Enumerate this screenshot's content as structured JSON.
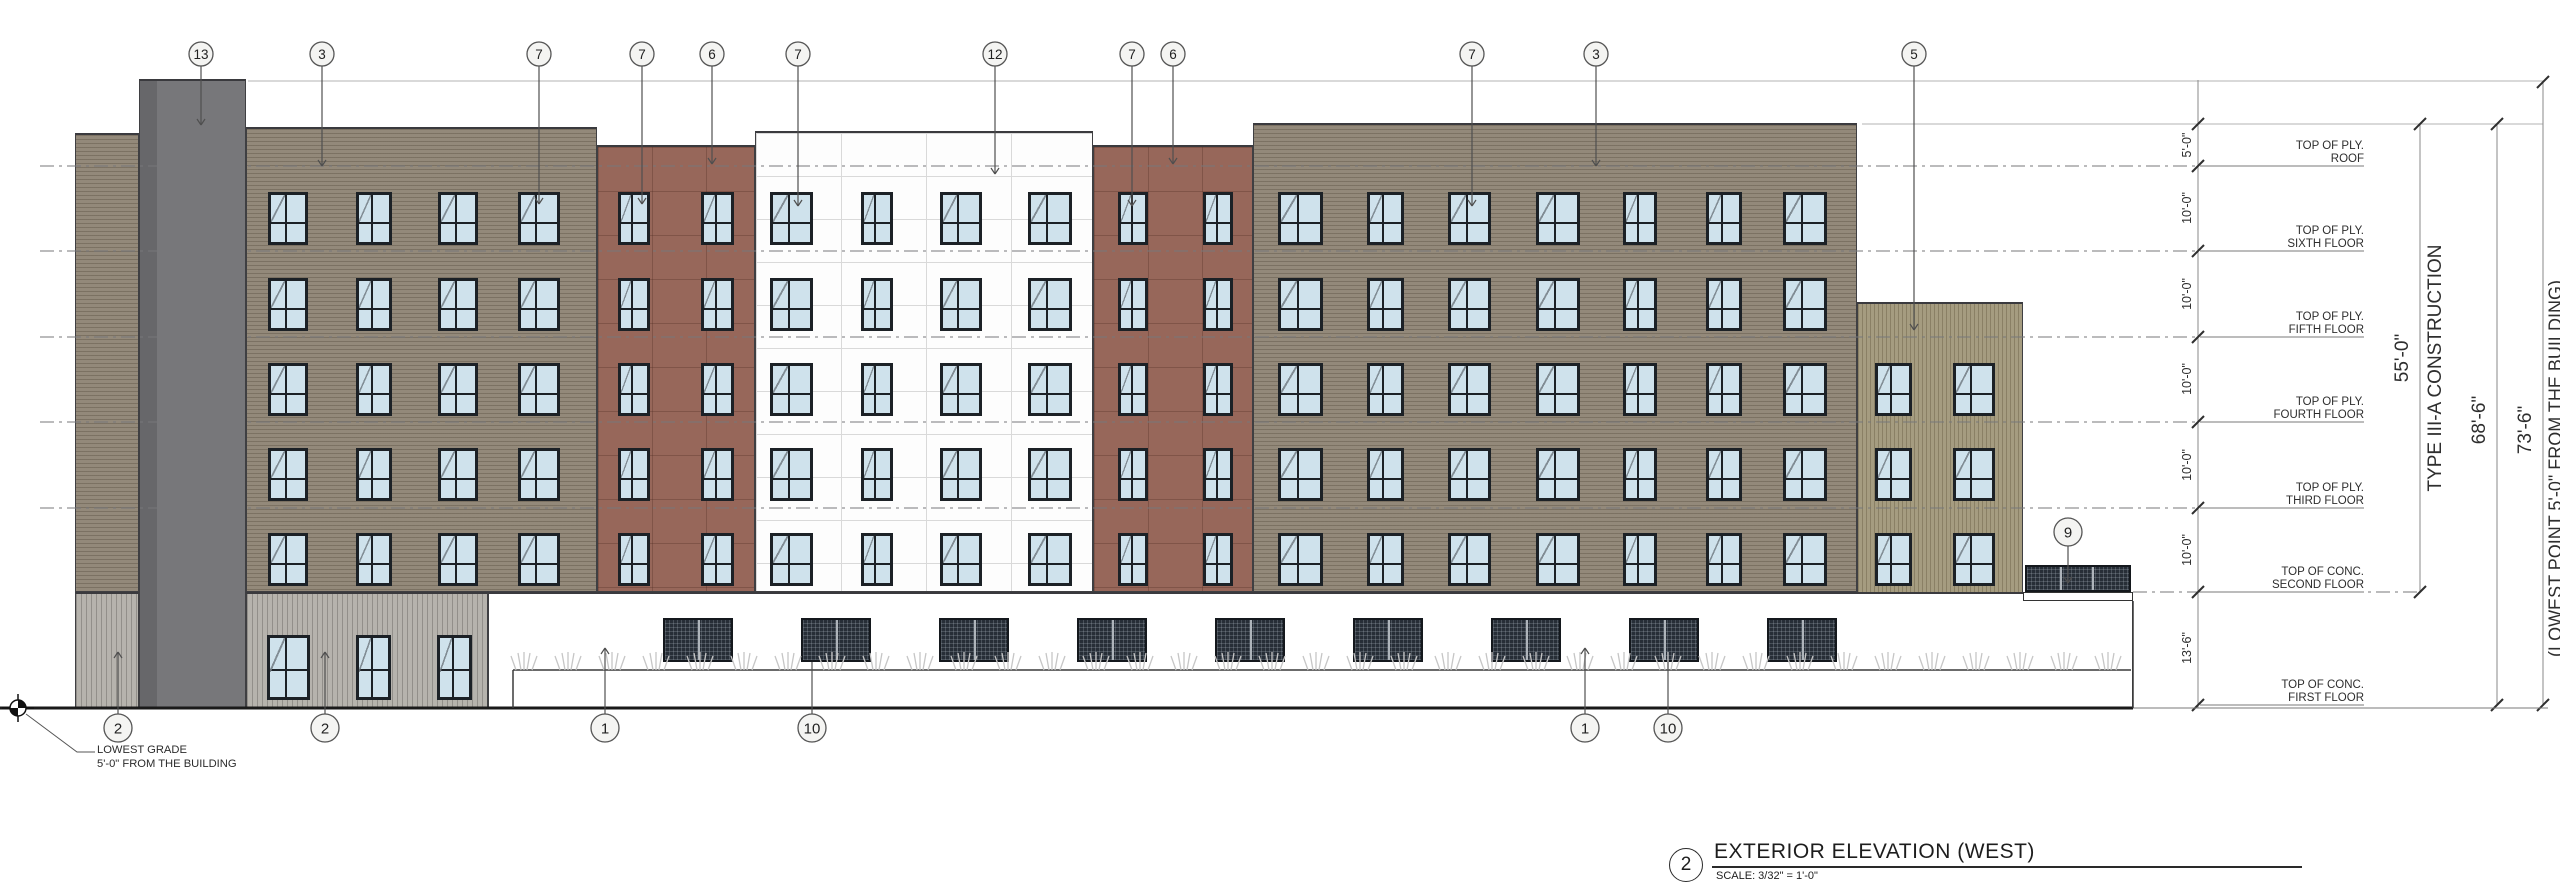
{
  "title_block": {
    "number": "2",
    "title": "EXTERIOR ELEVATION (WEST)",
    "scale": "SCALE:   3/32\" = 1'-0\""
  },
  "notes": {
    "grade_line1": "LOWEST GRADE",
    "grade_line2": "5'-0\" FROM THE BUILDING",
    "construction_type": "TYPE III-A CONSTRUCTION",
    "lowest_point": "(LOWEST POINT 5'-0\" FROM THE BUILDING)"
  },
  "floor_labels": [
    {
      "y": 166,
      "line1": "TOP OF PLY.",
      "line2": "ROOF"
    },
    {
      "y": 251,
      "line1": "TOP OF PLY.",
      "line2": "SIXTH FLOOR"
    },
    {
      "y": 337,
      "line1": "TOP OF PLY.",
      "line2": "FIFTH FLOOR"
    },
    {
      "y": 422,
      "line1": "TOP OF PLY.",
      "line2": "FOURTH FLOOR"
    },
    {
      "y": 508,
      "line1": "TOP OF PLY.",
      "line2": "THIRD FLOOR"
    },
    {
      "y": 592,
      "line1": "TOP OF CONC.",
      "line2": "SECOND FLOOR"
    },
    {
      "y": 705,
      "line1": "TOP OF CONC.",
      "line2": "FIRST FLOOR"
    }
  ],
  "dims": {
    "story": [
      {
        "label": "5'-0\"",
        "y": 145
      },
      {
        "label": "10'-0\"",
        "y": 208
      },
      {
        "label": "10'-0\"",
        "y": 294
      },
      {
        "label": "10'-0\"",
        "y": 379
      },
      {
        "label": "10'-0\"",
        "y": 465
      },
      {
        "label": "10'-0\"",
        "y": 550
      },
      {
        "label": "13'-6\"",
        "y": 648
      }
    ],
    "overall": [
      {
        "label": "55'-0\"",
        "x": 2420,
        "y1": 124,
        "y2": 592,
        "tx": 2403,
        "ty": 358
      },
      {
        "label": "68'-6\"",
        "x": 2497,
        "y1": 124,
        "y2": 705,
        "tx": 2480,
        "ty": 420
      },
      {
        "label": "73'-6\"",
        "x": 2543,
        "y1": 82,
        "y2": 705,
        "tx": 2526,
        "ty": 430
      }
    ],
    "construction_tx": 2436,
    "construction_ty": 368,
    "lowest_tx": 2556,
    "lowest_ty": 468,
    "tick_line_x": 2198,
    "tick_levels": [
      124,
      166,
      251,
      337,
      422,
      508,
      592,
      705
    ]
  },
  "keynotes_top": [
    {
      "label": "13",
      "x": 201,
      "tip": 125
    },
    {
      "label": "3",
      "x": 322,
      "tip": 166
    },
    {
      "label": "7",
      "x": 539,
      "tip": 204
    },
    {
      "label": "7",
      "x": 642,
      "tip": 204
    },
    {
      "label": "6",
      "x": 712,
      "tip": 164
    },
    {
      "label": "7",
      "x": 798,
      "tip": 206
    },
    {
      "label": "12",
      "x": 995,
      "tip": 174
    },
    {
      "label": "7",
      "x": 1132,
      "tip": 206
    },
    {
      "label": "6",
      "x": 1173,
      "tip": 164
    },
    {
      "label": "7",
      "x": 1472,
      "tip": 206
    },
    {
      "label": "3",
      "x": 1596,
      "tip": 166
    },
    {
      "label": "5",
      "x": 1914,
      "tip": 330
    }
  ],
  "keynotes_bottom": [
    {
      "label": "2",
      "x": 118,
      "tip": 652,
      "arrow": true
    },
    {
      "label": "2",
      "x": 325,
      "tip": 652,
      "arrow": true
    },
    {
      "label": "1",
      "x": 605,
      "tip": 648,
      "arrow": true
    },
    {
      "label": "10",
      "x": 812,
      "tip": 662,
      "arrow": false
    },
    {
      "label": "1",
      "x": 1585,
      "tip": 648,
      "arrow": true
    },
    {
      "label": "10",
      "x": 1668,
      "tip": 662,
      "arrow": false
    }
  ],
  "keynote_9": {
    "label": "9",
    "x": 2068,
    "y": 532,
    "tip": 583
  },
  "building": {
    "sections": [
      {
        "name": "left-wing",
        "x": 75,
        "y": 133,
        "w": 64,
        "h": 459,
        "tex": "taupe"
      },
      {
        "name": "left-wing-base",
        "x": 75,
        "y": 592,
        "w": 64,
        "h": 116,
        "tex": "vgray"
      },
      {
        "name": "elevator-band",
        "x": 139,
        "y": 79,
        "w": 107,
        "h": 629,
        "tex": "dark"
      },
      {
        "name": "facade-taupe-left",
        "x": 246,
        "y": 127,
        "w": 351,
        "h": 465,
        "tex": "taupe"
      },
      {
        "name": "facade-brick-left",
        "x": 597,
        "y": 145,
        "w": 158,
        "h": 447,
        "tex": "brick"
      },
      {
        "name": "facade-white-center",
        "x": 755,
        "y": 131,
        "w": 338,
        "h": 461,
        "tex": "white"
      },
      {
        "name": "facade-brick-right",
        "x": 1093,
        "y": 145,
        "w": 160,
        "h": 447,
        "tex": "brick"
      },
      {
        "name": "facade-taupe-right",
        "x": 1253,
        "y": 123,
        "w": 604,
        "h": 469,
        "tex": "taupe"
      },
      {
        "name": "olive-tower",
        "x": 1857,
        "y": 302,
        "w": 166,
        "h": 295,
        "tex": "olive"
      },
      {
        "name": "podium-siding",
        "x": 246,
        "y": 592,
        "w": 242,
        "h": 116,
        "tex": "vgray"
      },
      {
        "name": "podium-white",
        "x": 488,
        "y": 592,
        "w": 1645,
        "h": 116,
        "tex": "plain"
      }
    ],
    "window_rows": [
      192,
      278,
      363,
      448,
      533
    ],
    "window_h": 53,
    "window_cols": [
      [
        268,
        40
      ],
      [
        356,
        36
      ],
      [
        438,
        40
      ],
      [
        518,
        42
      ],
      [
        618,
        32
      ],
      [
        701,
        33
      ],
      [
        770,
        43
      ],
      [
        861,
        32
      ],
      [
        940,
        42
      ],
      [
        1028,
        44
      ],
      [
        1118,
        30
      ],
      [
        1203,
        30
      ],
      [
        1278,
        45
      ],
      [
        1367,
        37
      ],
      [
        1448,
        43
      ],
      [
        1536,
        44
      ],
      [
        1623,
        34
      ],
      [
        1706,
        36
      ],
      [
        1783,
        44
      ]
    ],
    "olive_rows": [
      363,
      448,
      533
    ],
    "olive_cols": [
      [
        1875,
        37
      ],
      [
        1953,
        42
      ]
    ],
    "ground_windows": {
      "y": 635,
      "h": 65,
      "cols": [
        [
          267,
          43
        ],
        [
          356,
          35
        ],
        [
          437,
          35
        ]
      ]
    },
    "louvers": {
      "centers": [
        698,
        836,
        974,
        1112,
        1250,
        1388,
        1526,
        1664,
        1802
      ],
      "y": 618,
      "w": 70,
      "h": 44
    },
    "railing": {
      "x": 2025,
      "y": 565,
      "w": 106,
      "h": 27
    },
    "slab": {
      "x": 2023,
      "y": 592,
      "w": 110,
      "h": 9
    },
    "plants": {
      "x1": 524,
      "x2": 2122,
      "step": 44,
      "base_y": 670
    },
    "wall_line": {
      "x1": 513,
      "x2": 2131,
      "y": 670
    },
    "grade_y": 708,
    "grade_x2": 2133,
    "grade_thin_x2": 2548,
    "grade_marker": {
      "x": 18,
      "y": 708
    }
  },
  "ref_lines": {
    "floor_dash": [
      166,
      251,
      337,
      422,
      508
    ],
    "dash_x1": 40,
    "dash_x2": 2205,
    "second_floor": {
      "y": 592,
      "x1": 2133,
      "x2": 2420
    },
    "top_line": {
      "y": 81,
      "x1": 248,
      "x2": 2543
    },
    "parapet_line": {
      "y": 124,
      "x1": 1862,
      "x2": 2543
    }
  },
  "colors": {
    "taupe": "#93897a",
    "taupe_line": "rgba(62,52,38,0.28)",
    "dark_band": "#77777a",
    "dark_band_strip": "#67676a",
    "brick": "#97675a",
    "brick_joint": "rgba(75,40,30,0.30)",
    "white_panel": "#fdfdfd",
    "white_joint": "#d9d9d9",
    "olive": "#a59c80",
    "olive_line": "rgba(75,65,38,0.30)",
    "vgray": "#b6b3ad",
    "vgray_line": "rgba(0,0,0,0.20)",
    "pane": "#cfe2ec",
    "frame": "#1c2126",
    "louver": "#272e37",
    "annotation": "#2e2e2e",
    "line_gray": "#8a8a8a"
  }
}
